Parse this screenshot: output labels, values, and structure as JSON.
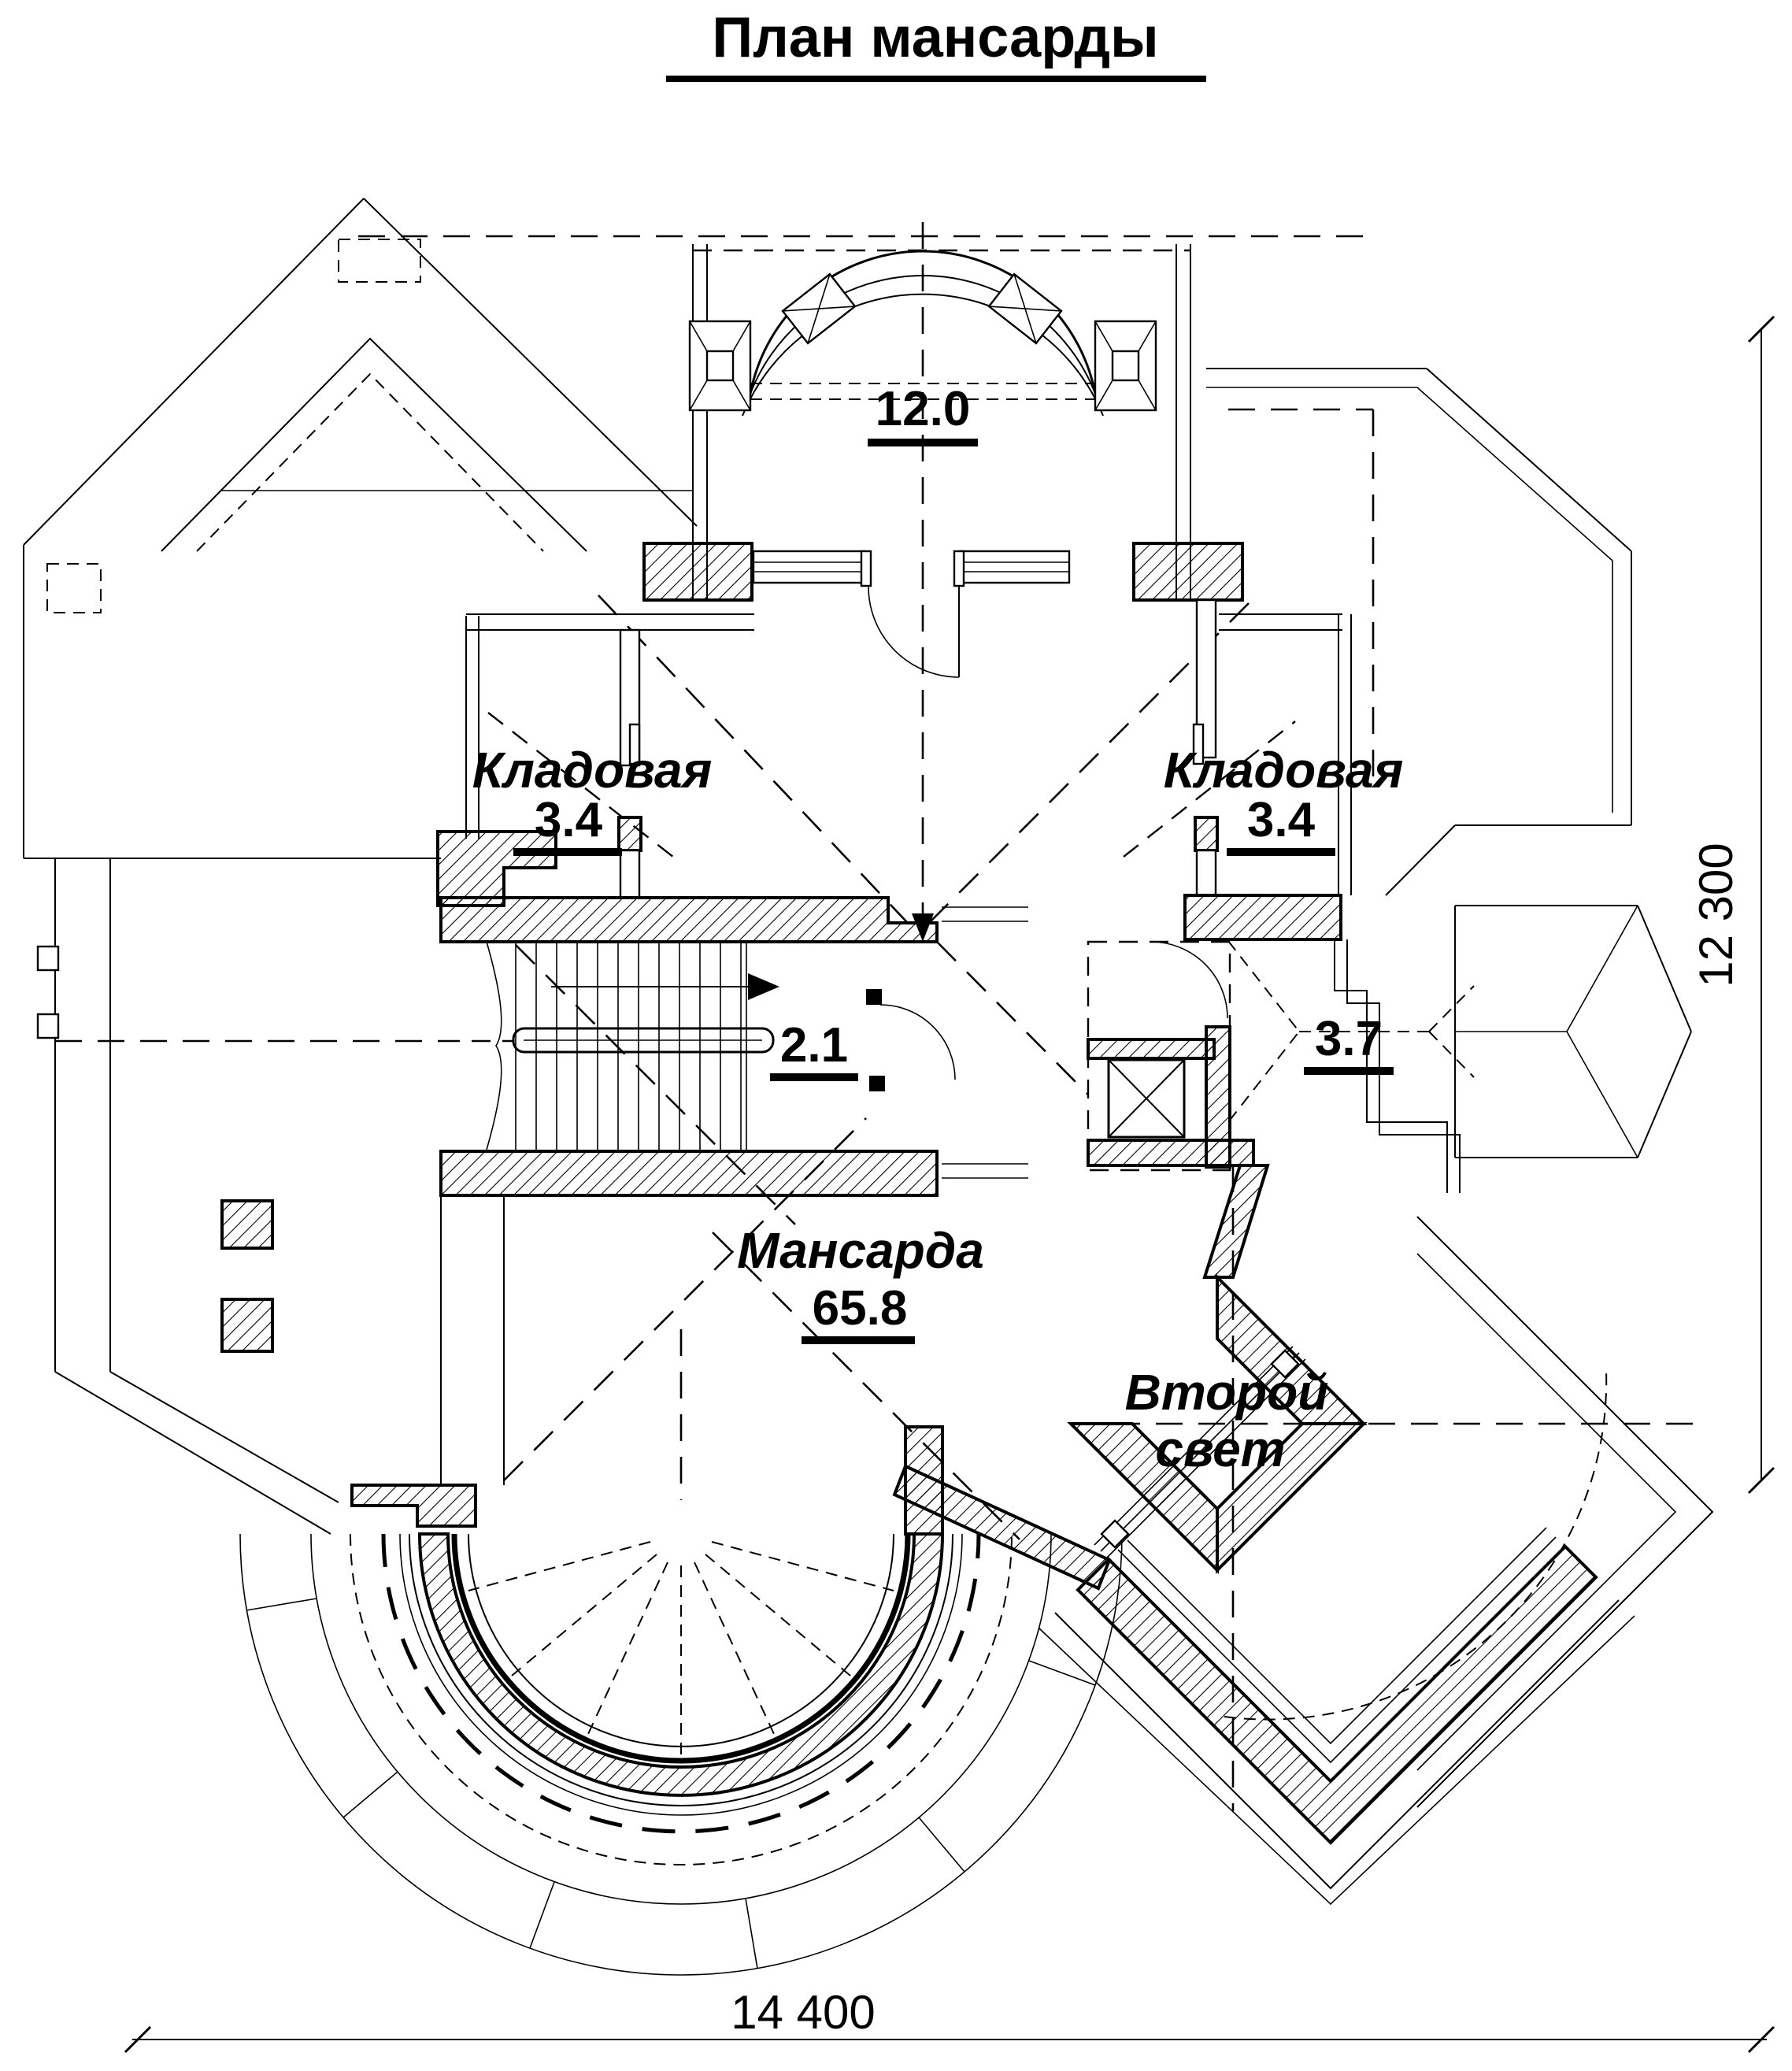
{
  "title": "План мансарды",
  "rooms": {
    "balcony": {
      "area": "12.0"
    },
    "storage_left": {
      "name": "Кладовая",
      "area": "3.4"
    },
    "storage_right": {
      "name": "Кладовая",
      "area": "3.4"
    },
    "hall": {
      "area": "2.1"
    },
    "closet": {
      "area": "3.7"
    },
    "attic": {
      "name": "Мансарда",
      "area": "65.8"
    },
    "void": {
      "line1": "Второй",
      "line2": "свет"
    }
  },
  "dimensions": {
    "width": "14 400",
    "height": "12 300"
  },
  "colors": {
    "ink": "#000000",
    "paper": "#ffffff"
  }
}
